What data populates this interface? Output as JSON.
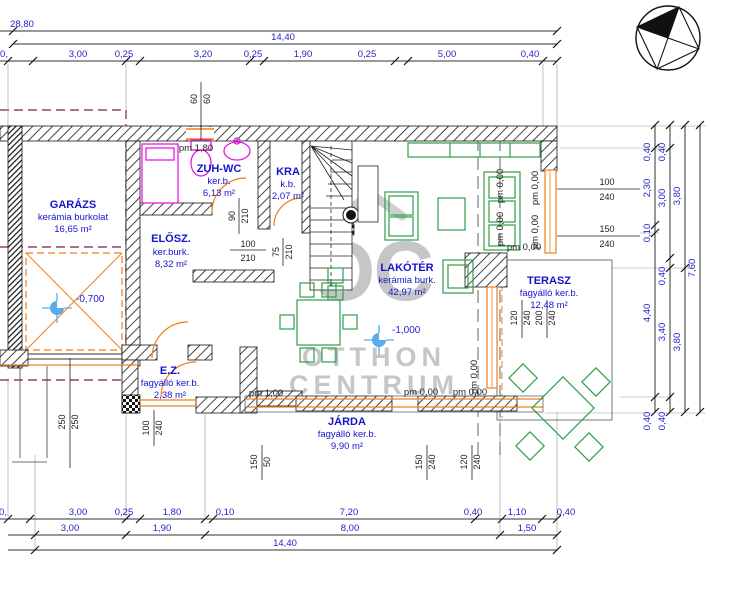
{
  "title": "Földszinti alaprajz",
  "dims": {
    "top": {
      "total": "28,80",
      "building": "14,40",
      "row": [
        "0,",
        "3,00",
        "0,25",
        "3,20",
        "0,25",
        "1,90",
        "0,25",
        "5,00",
        "0,40"
      ]
    },
    "bottom": {
      "row1": [
        "0,",
        "3,00",
        "0,25",
        "1,80",
        "0,10",
        "7,20",
        "0,40",
        "1,10",
        "0,40"
      ],
      "row2": [
        "3,00",
        "1,90",
        "8,00",
        "1,50"
      ],
      "total": "14,40"
    },
    "right": {
      "c1": [
        "0,40",
        "2,30",
        "0,10",
        "4,40",
        "0,40"
      ],
      "c2": [
        "0,40",
        "3,00",
        "0,40",
        "3,40",
        "0,40"
      ],
      "c3": [
        "3,80",
        "3,80"
      ],
      "c4": [
        "7,60"
      ]
    }
  },
  "rooms": {
    "garazs": {
      "name": "GARÁZS",
      "finish": "kerámia burkolat",
      "area": "16,65 m²"
    },
    "zuhwc": {
      "name": "ZUH-WC",
      "finish": "ker.b.",
      "area": "6,13 m²"
    },
    "kra": {
      "name": "KRA",
      "finish": "k.b.",
      "area": "2,07 m²"
    },
    "elosz": {
      "name": "ELŐSZ.",
      "finish": "ker.burk.",
      "area": "8,32 m²"
    },
    "lakoter": {
      "name": "LAKÓTÉR",
      "finish": "kerámia burk.",
      "area": "42,97 m²"
    },
    "terasz": {
      "name": "TERASZ",
      "finish": "fagyálló ker.b.",
      "area": "12,48 m²"
    },
    "ez": {
      "name": "E.Z.",
      "finish": "fagyálló ker.b.",
      "area": "2,38 m²"
    },
    "jarda": {
      "name": "JÁRDA",
      "finish": "fagyálló ker.b.",
      "area": "9,90 m²"
    }
  },
  "openings": {
    "win6060": {
      "a": "60",
      "b": "60"
    },
    "door90": {
      "a": "90",
      "b": "210"
    },
    "door100": {
      "a": "100",
      "b": "210"
    },
    "door75": {
      "a": "75",
      "b": "210"
    },
    "win100240": {
      "a": "100",
      "b": "240"
    },
    "win150240": {
      "a": "150",
      "b": "240"
    },
    "ezdoor": {
      "a": "100",
      "b": "240"
    },
    "gardoor": {
      "a": "250",
      "b": "250"
    },
    "walk15050": {
      "a": "150",
      "b": "50"
    },
    "s150240": {
      "a": "150",
      "b": "240"
    },
    "s120240": {
      "a": "120",
      "b": "240"
    },
    "t120240": {
      "a": "120",
      "b": "240"
    },
    "t200240": {
      "a": "200",
      "b": "240"
    }
  },
  "levels": {
    "garage": "-0,700",
    "living": "-1,000"
  },
  "pm": {
    "shower": "pm 1,80",
    "walk": "pm 1,00",
    "zero": "pm 0,00"
  },
  "watermark": {
    "logo": "OC",
    "line1": "OTTHON",
    "line2": "CENTRUM"
  },
  "colors": {
    "dim_blue": "#2323cc",
    "room_blue": "#1414cc",
    "wall_black": "#141414",
    "fixture_magenta": "#e51ae5",
    "furniture_green": "#2e9e4a",
    "door_orange": "#ef7f1a",
    "boundary_maroon": "#8d4560",
    "marker_blue": "#57aeea",
    "watermark_gray": "#c6c6c6"
  }
}
